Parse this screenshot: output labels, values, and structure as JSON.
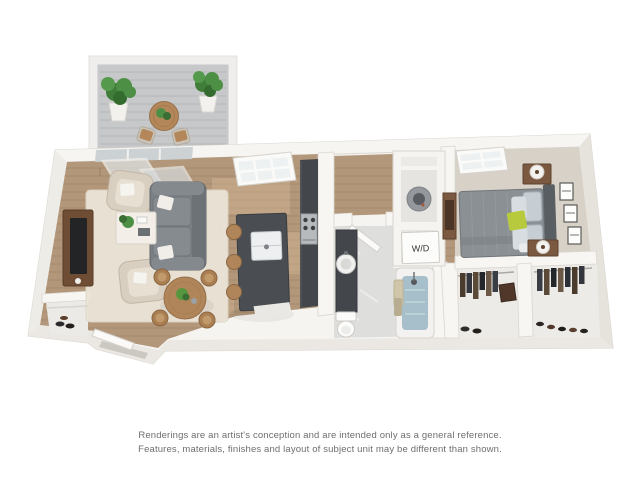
{
  "scene": {
    "type": "3d-floorplan-rendering",
    "unit_style": "one-bedroom, one-bath apartment with balcony",
    "rooms": [
      "balcony",
      "living-room",
      "dining-area",
      "kitchen",
      "hallway",
      "bathroom",
      "washer-dryer-closet",
      "bedroom",
      "walk-in-closets",
      "entry"
    ]
  },
  "labels": {
    "washer_dryer": "W/D"
  },
  "disclaimer": {
    "line1": "Renderings are an artist's conception and are intended only as a general reference.",
    "line2": "Features, materials, finishes and layout of subject unit may be different than shown."
  },
  "colors": {
    "background": "#ffffff",
    "wall": "#f5f4f1",
    "wall_edge": "#d9d5cf",
    "wood_floor": "#b2977a",
    "tile_floor": "#dedfdd",
    "carpet": "#d8d1c7",
    "counter_dark": "#43474b",
    "island_dark": "#4a4e52",
    "sofa_gray": "#7b8085",
    "armchair_beige": "#d9cfc1",
    "furniture_wood": "#b0855a",
    "plant_green": "#4e8f46",
    "accent_lime": "#b7ca3e",
    "tub_water": "#a7bfca",
    "disclaimer_text": "#6e6e6e"
  }
}
